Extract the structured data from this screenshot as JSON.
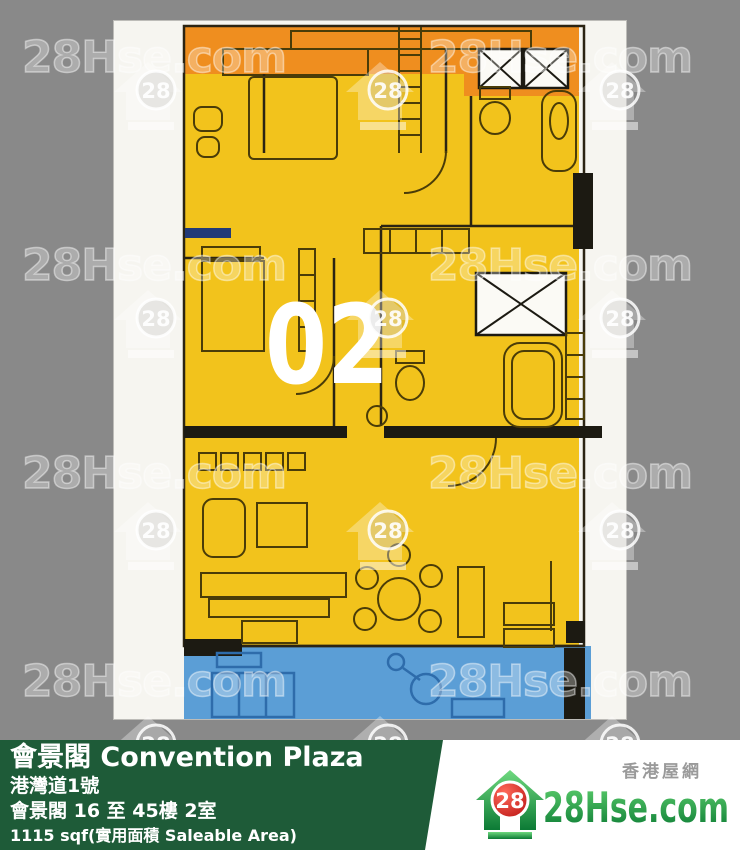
{
  "page": {
    "background": "#898989"
  },
  "watermark": {
    "text": "28Hse.com",
    "badge": "28",
    "text_rows_y": [
      32,
      240,
      448,
      656
    ],
    "text_cols_x": [
      22,
      428
    ],
    "icon_rows_y": [
      60,
      288,
      500,
      714
    ],
    "icon_cols_x": [
      112,
      344,
      576
    ]
  },
  "floor_plan": {
    "unit_label": "02",
    "colors": {
      "unit_yellow": "#f2c31c",
      "adjacent_orange": "#ef8e1f",
      "adjacent_blue": "#5b9ed6",
      "wall_black": "#1c1a12",
      "furniture_line": "#4a3c08",
      "blue_line": "#2e6cab",
      "navy_wall": "#223a77"
    }
  },
  "info_bar": {
    "background": "#1e5b38",
    "title": "會景閣 Convention Plaza",
    "address": "港灣道1號",
    "floors_unit": "會景閣 16 至 45樓 2室",
    "area": "1115 sqf(實用面積 Saleable Area)"
  },
  "logo": {
    "site_name": "28Hse.com",
    "site_name_cn": "香港屋網",
    "badge": "28",
    "green": "#0d8a3c",
    "green_light": "#5ecf6e",
    "red": "#d42020"
  }
}
